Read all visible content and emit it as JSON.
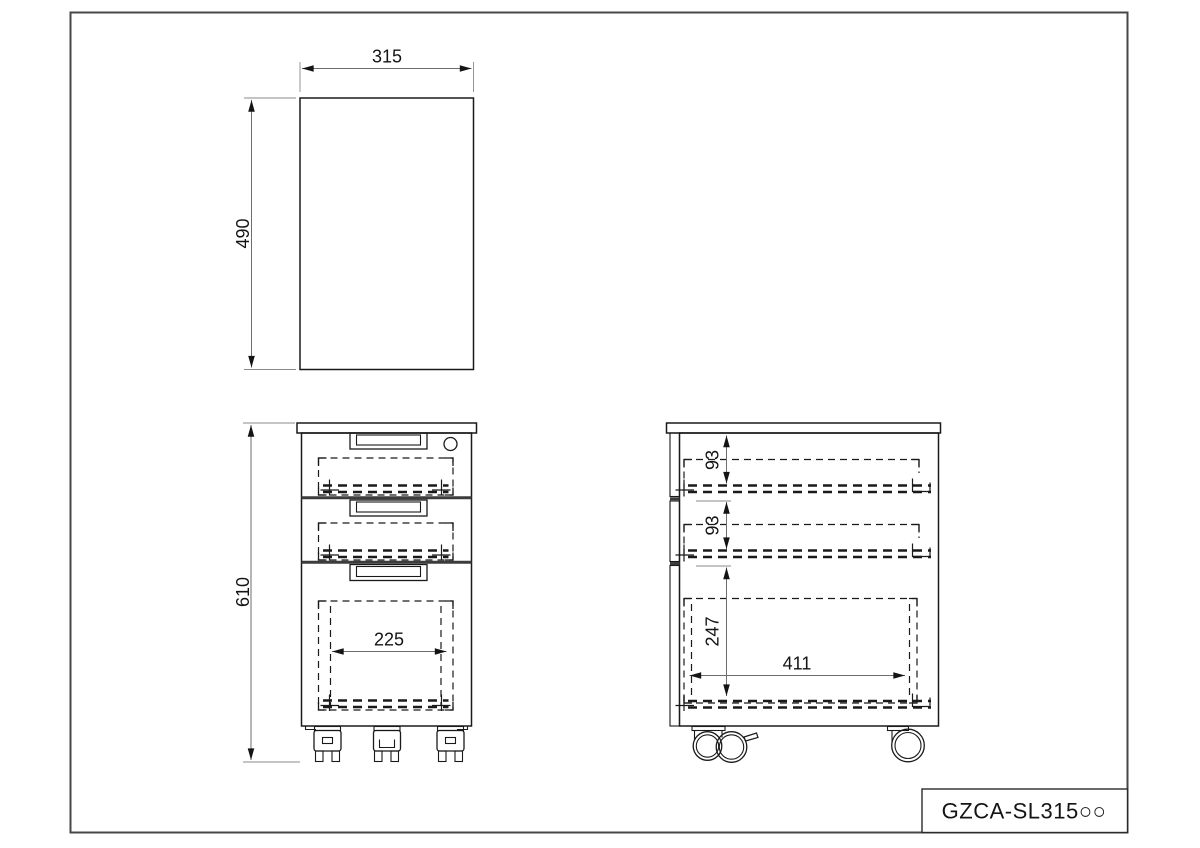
{
  "drawing_code": "GZCA-SL315○○",
  "dimensions": {
    "top_view": {
      "width": "315",
      "depth": "490"
    },
    "front_view": {
      "height": "610",
      "drawer_inner_width": "225"
    },
    "side_view": {
      "drawer1_inner_height": "93",
      "drawer2_inner_height": "93",
      "file_drawer_inner_height": "247",
      "drawer_inner_depth": "411"
    }
  },
  "colors": {
    "background": "#ffffff",
    "line": "#1a1a1a",
    "dimension_line": "#6e6e6e",
    "frame_border": "#474747"
  }
}
